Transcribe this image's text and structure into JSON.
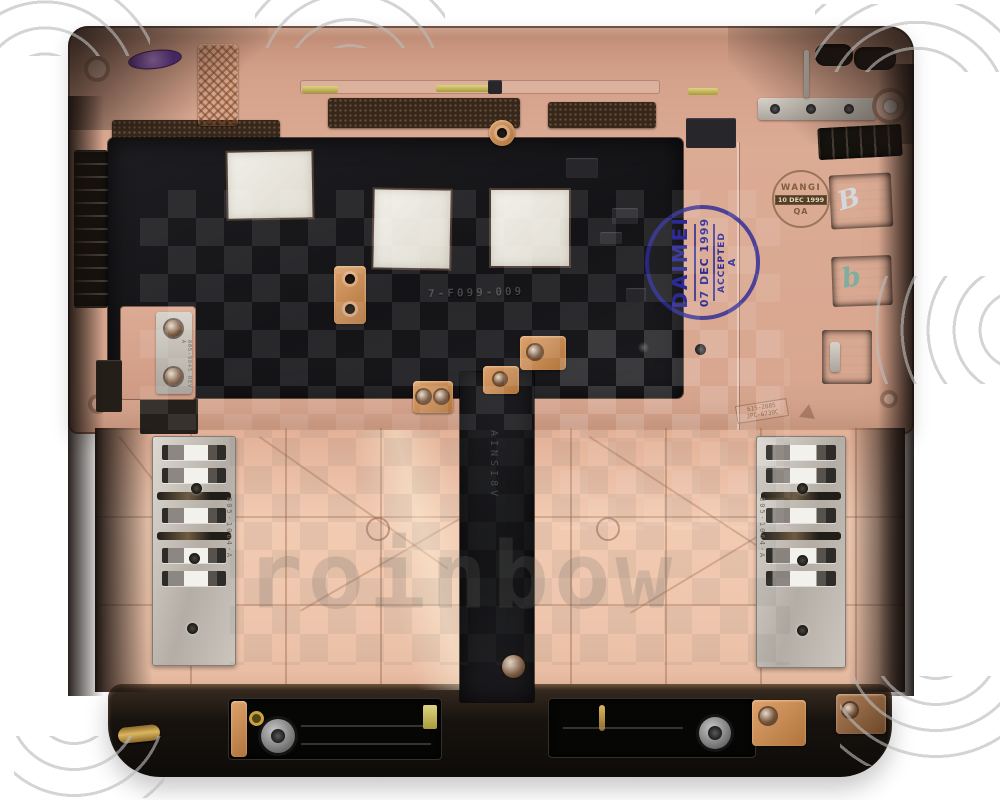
{
  "stamps": {
    "daimei": {
      "name": "DAIMEI",
      "date": "07 DEC 1999",
      "status": "ACCEPTED",
      "grade": "A"
    },
    "wangi": {
      "name": "WANGI",
      "date": "10 DEC 1999",
      "dept": "QA"
    }
  },
  "part_markings": {
    "bracket_label": "805-9845 REV A",
    "left_shield_label": "805-1064-A",
    "right_shield_label": "805-1064-A",
    "molded_code_line1": "615-2885",
    "molded_code_line2": "JPC-6730C",
    "mylar_code": "7-F099-009",
    "strip_code": "AINSI8V"
  },
  "handwriting": {
    "mark1": "B",
    "mark2": "b"
  },
  "watermark": {
    "text": "roinbow"
  },
  "colors": {
    "case_rose": "#d9a38c",
    "palm_rose": "#efc7af",
    "mylar_black": "#1a191d",
    "smoke_edge": "#241c17",
    "copper": "#c98a57",
    "shield_silver": "#c9c3bb",
    "stamp_blue": "#2c2a96",
    "stamp_brown": "#7d5f3c",
    "pad_white": "#ece9e2"
  }
}
